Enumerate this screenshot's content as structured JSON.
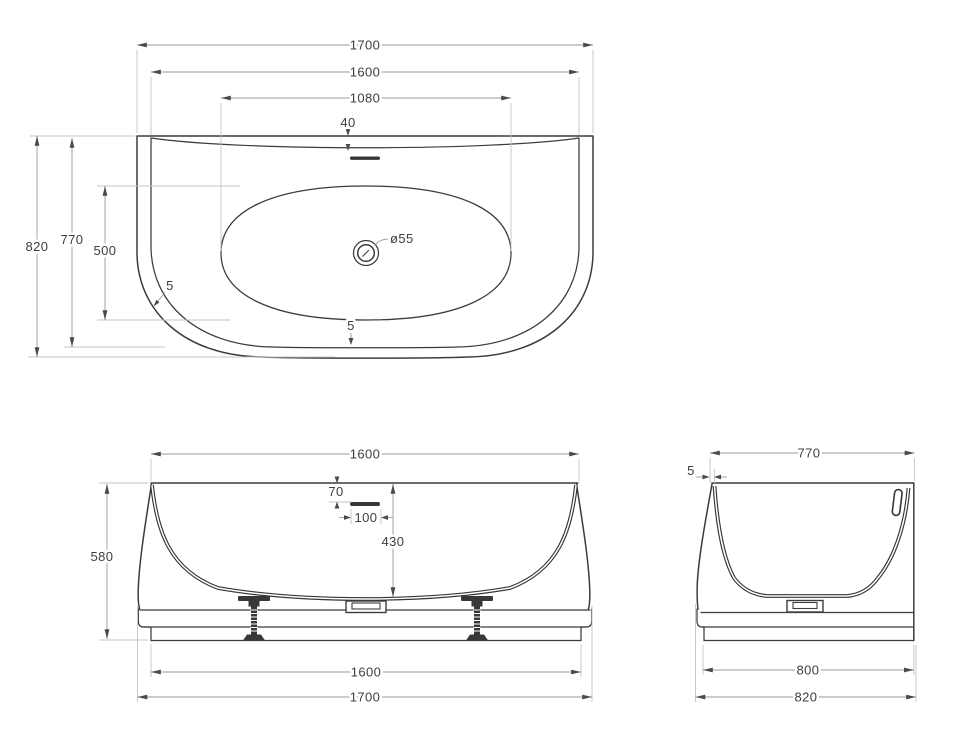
{
  "palette": {
    "background": "#ffffff",
    "object_line": "#3c3c3c",
    "section_line": "#353535",
    "dimension_line": "#9a9a9a",
    "extension_line": "#c4c4c4",
    "text": "#3e3e3e"
  },
  "top_view": {
    "dims": {
      "overall_length": "1700",
      "rim_length": "1600",
      "basin_length": "1080",
      "rim_offset_back": "40",
      "overall_width": "820",
      "rim_width": "770",
      "basin_width": "500",
      "wall_thickness_corner": "5",
      "wall_thickness_front": "5",
      "drain_diameter": "ø55"
    }
  },
  "front_view": {
    "dims": {
      "rim_length": "1600",
      "overflow_drop": "70",
      "overflow_length": "100",
      "inner_depth": "430",
      "overall_height": "580",
      "base_length": "1600",
      "overall_length": "1700"
    }
  },
  "side_view": {
    "dims": {
      "rim_width": "770",
      "wall_thickness": "5",
      "base_width": "800",
      "overall_width": "820"
    }
  }
}
